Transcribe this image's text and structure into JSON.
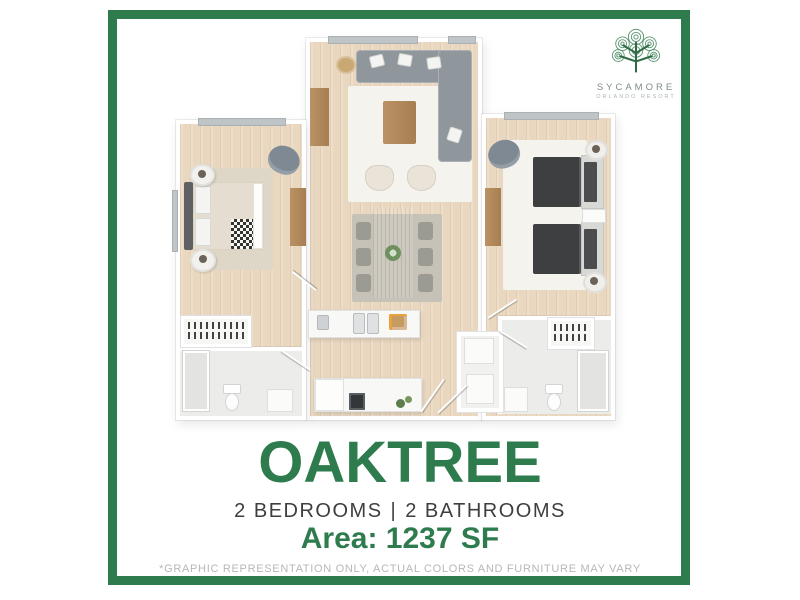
{
  "logo": {
    "icon": "sycamore-tree-icon",
    "brand": "SYCAMORE",
    "subtitle": "ORLANDO RESORT"
  },
  "plan_info": {
    "name": "OAKTREE",
    "specs": {
      "bedrooms": "2 BEDROOMS",
      "separator": "|",
      "bathrooms": "2 BATHROOMS"
    },
    "area": "Area: 1237 SF",
    "disclaimer": "*GRAPHIC REPRESENTATION ONLY, ACTUAL COLORS AND FURNITURE MAY VARY"
  },
  "colors": {
    "accent_green": "#2e7c4e",
    "specs_text": "#3e3e3e",
    "disclaimer_text": "#b7b7b7",
    "logo_text": "#7f8e84",
    "wood_floor": "#e9d7bf",
    "sofa_gray": "#8f969c"
  }
}
